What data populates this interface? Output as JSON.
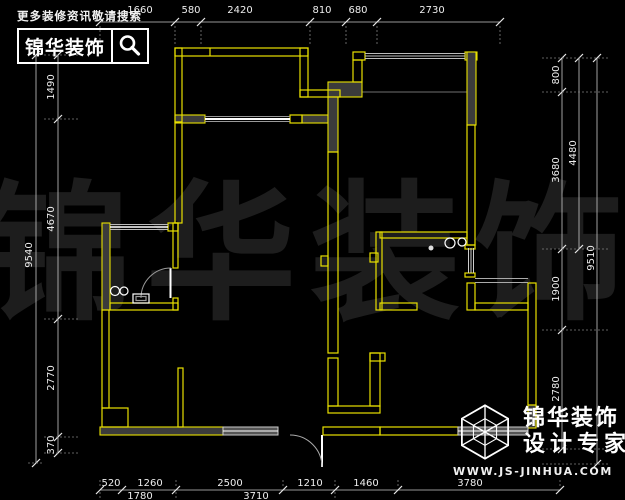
{
  "watermark": {
    "text": "锦华装饰"
  },
  "header": {
    "tagline": "更多装修资讯敬请搜索",
    "logo": "锦华装饰"
  },
  "footer": {
    "brand": "锦华装饰",
    "slogan": "设计专家",
    "website": "WWW.JS-JINHUA.COM"
  },
  "colors": {
    "background": "#000000",
    "wall": "#e8e000",
    "wall_fill": "#3b3b3b",
    "dim_line": "#c8c8c8",
    "dim_text": "#eeeeee",
    "watermark": "#1d1d1d",
    "window": "#ffffff"
  },
  "dims": {
    "top": [
      "1660",
      "580",
      "2420",
      "810",
      "680",
      "2730"
    ],
    "left_inner": [
      "1490",
      "4670",
      "2770",
      "370"
    ],
    "left_outer": "9540",
    "right_inner": [
      "800",
      "3680",
      "1900",
      "2780"
    ],
    "right_mid": "4480",
    "right_outer": "9510",
    "bottom_row1": [
      "520",
      "1260",
      "2500",
      "1210",
      "1460",
      "3780"
    ],
    "bottom_row2": [
      "1780",
      "3710"
    ]
  }
}
